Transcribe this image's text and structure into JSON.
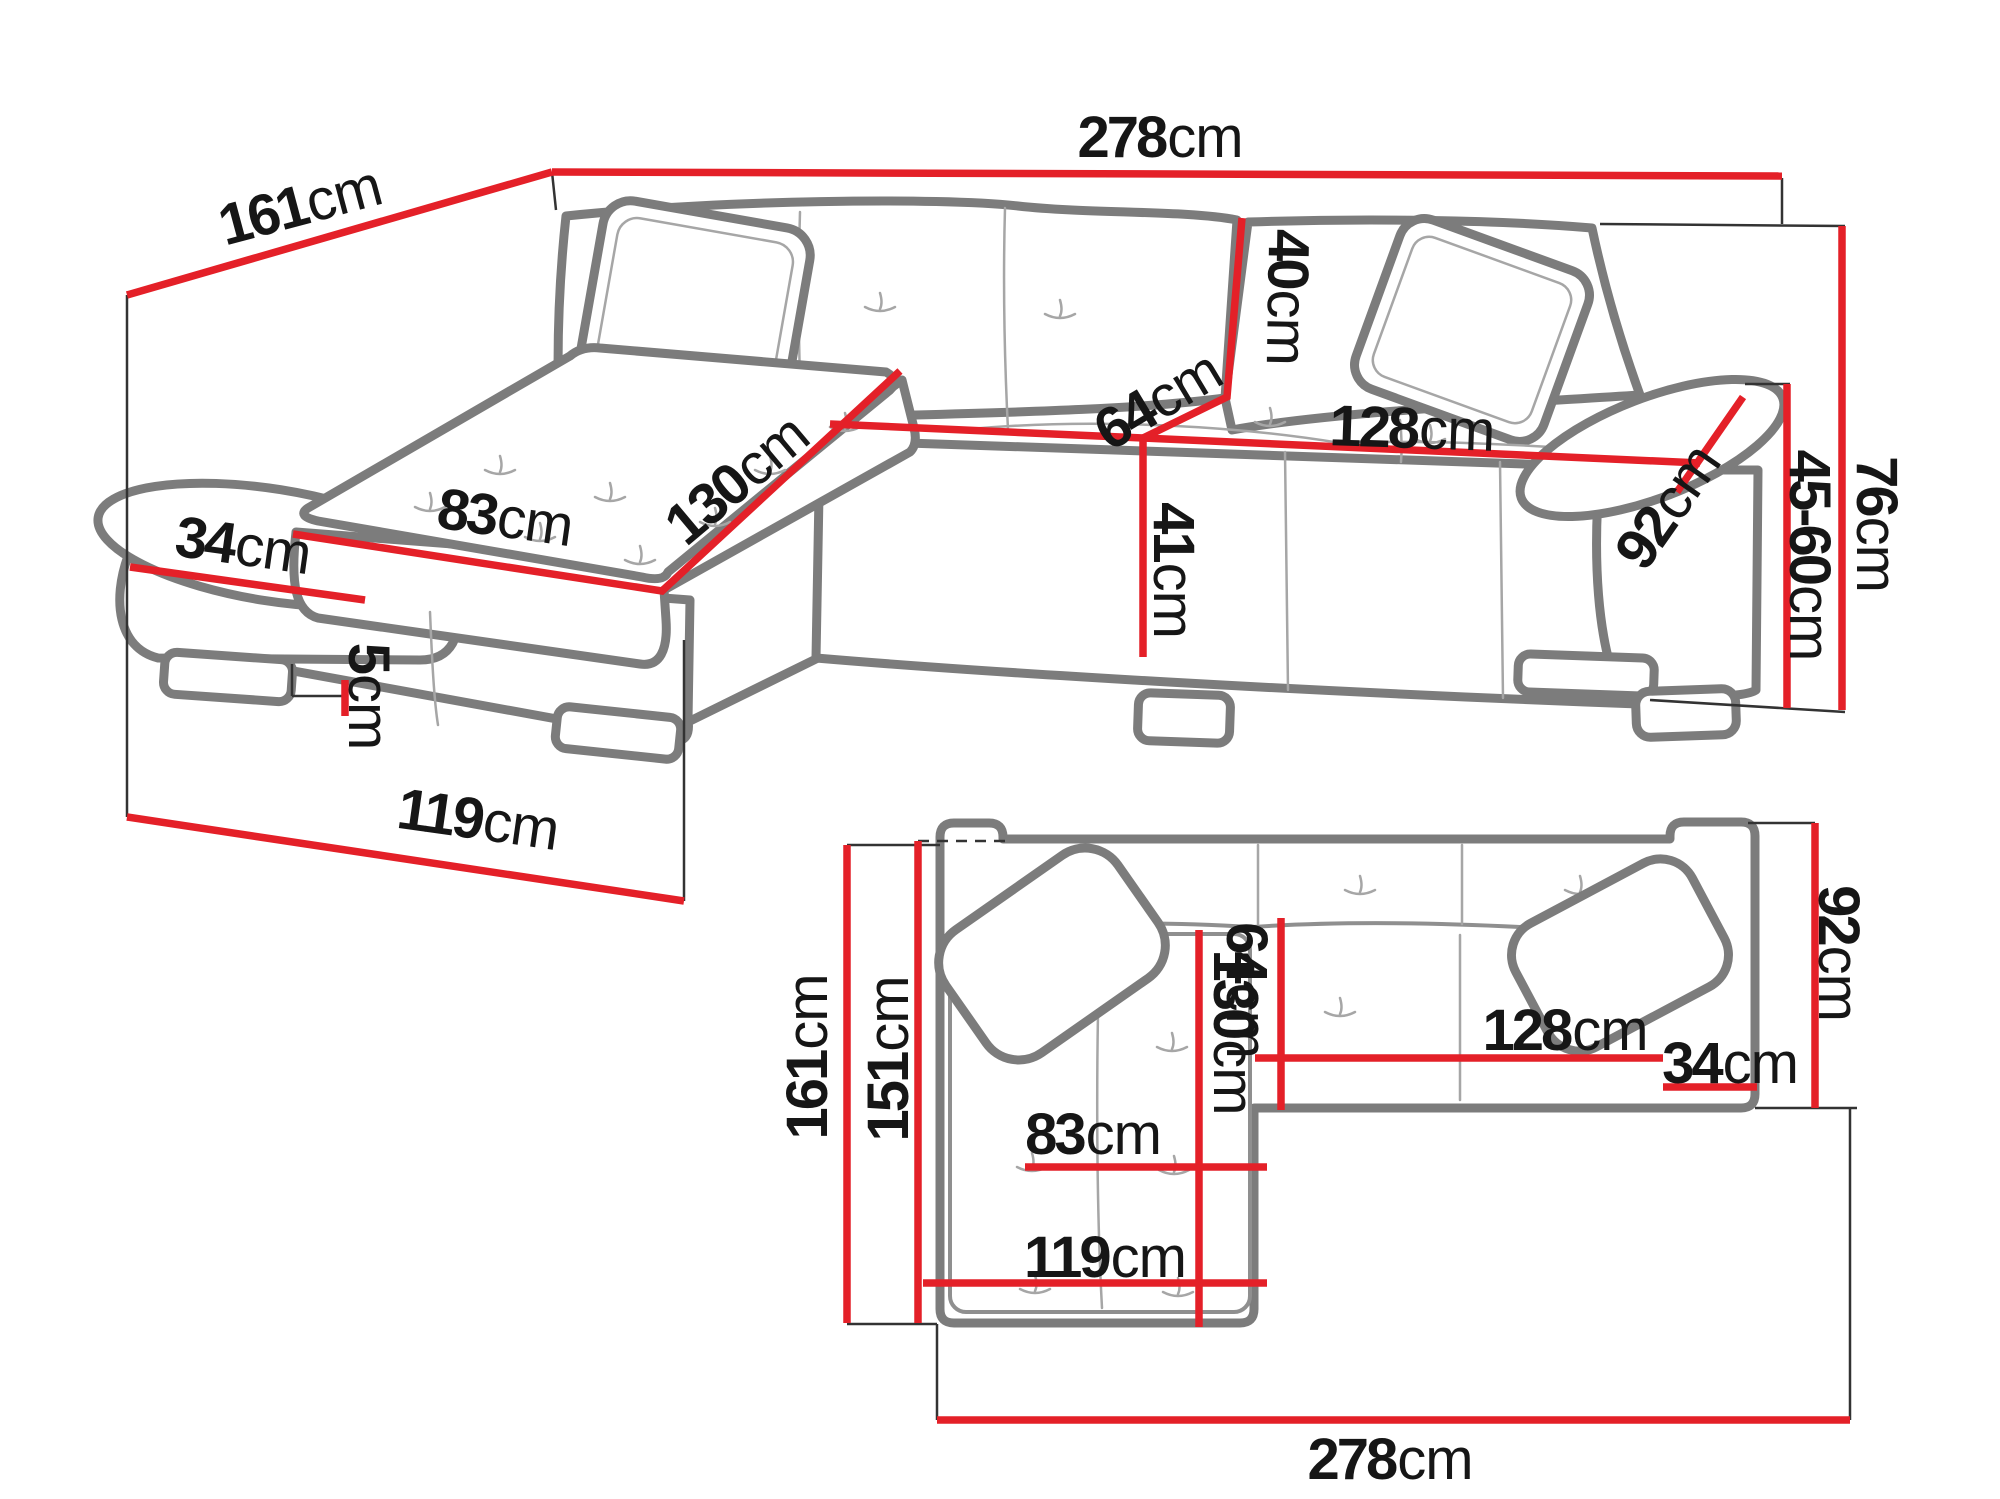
{
  "unit": "cm",
  "colors": {
    "dimension_red": "#e42028",
    "outline_gray": "#7c7c7c",
    "detail_gray": "#a6a6a6",
    "text_black": "#161616",
    "background": "#ffffff"
  },
  "dimensions": {
    "perspective": {
      "total_width": "278",
      "total_depth": "161",
      "armrest_width": "34",
      "chaise_seat_width": "83",
      "chaise_length": "130",
      "backrest_height": "40",
      "seat_depth": "64",
      "seat_width": "128",
      "seat_height": "41",
      "armrest_length": "92",
      "leg_height": "5",
      "chaise_footprint_length": "119",
      "armrest_height_range": "45-60",
      "total_height": "76"
    },
    "plan": {
      "total_depth": "161",
      "inner_depth": "151",
      "chaise_length": "130",
      "seat_depth": "64",
      "chaise_seat_width": "83",
      "chaise_footprint_length": "119",
      "seat_width": "128",
      "armrest_width": "34",
      "section_depth": "92",
      "total_width": "278"
    }
  }
}
